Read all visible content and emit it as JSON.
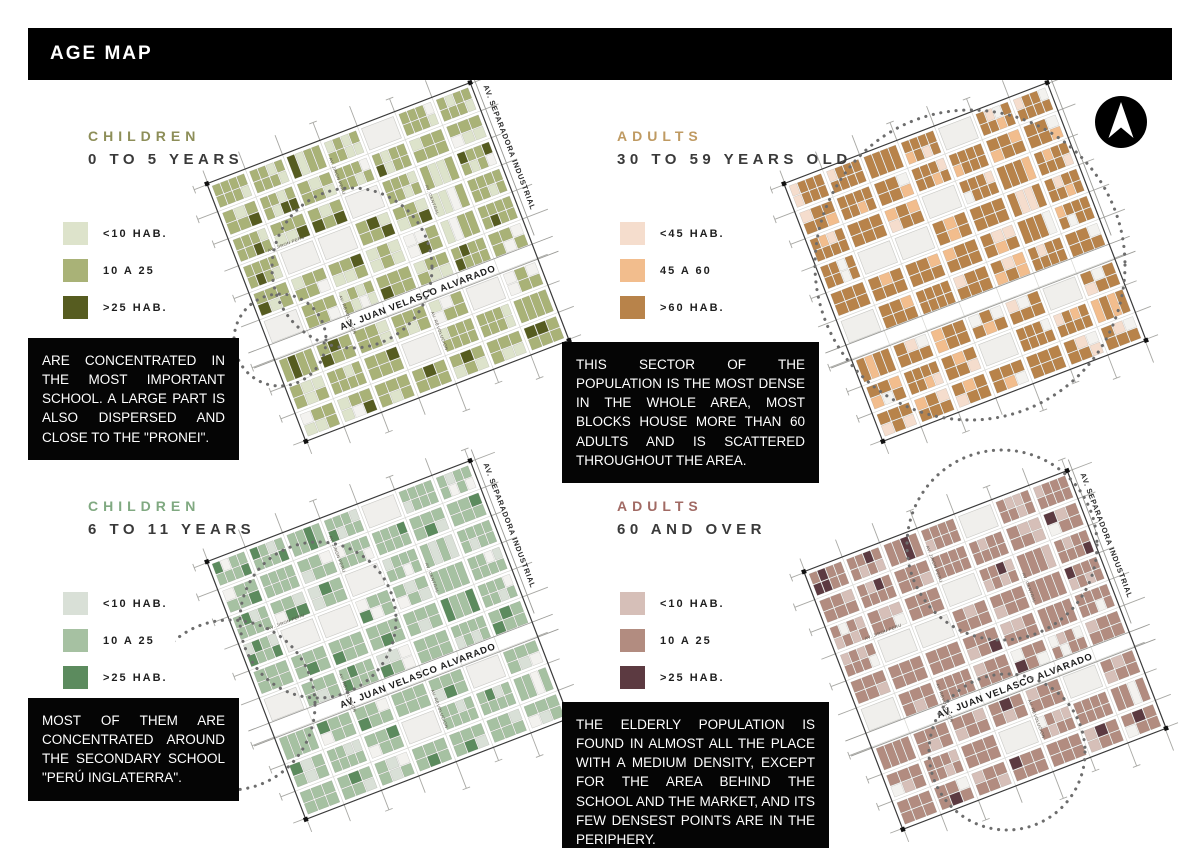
{
  "page": {
    "title": "AGE MAP",
    "background": "#ffffff",
    "header_bg": "#000000",
    "header_text_color": "#ffffff"
  },
  "north_arrow": {
    "icon": "north-arrow",
    "bg": "#000000",
    "fg": "#ffffff"
  },
  "map_shared": {
    "rotation": -21,
    "geo_seed": 1337,
    "plazas": [
      [
        0,
        4
      ],
      [
        2,
        3
      ],
      [
        3,
        1
      ],
      [
        3,
        2
      ],
      [
        5,
        0
      ],
      [
        6,
        5
      ],
      [
        7,
        3
      ]
    ],
    "street_color": "#a8a8a4",
    "border_color": "#3a3a3a",
    "dotted_circle_color": "#6d6d6d"
  },
  "map_labels": {
    "main_avenue": "AV. JUAN VELASCO ALVARADO",
    "industrial_avenue": "AV. SEPARADORA INDUSTRIAL",
    "minor_streets": [
      "AV. JIRON PERU",
      "AV. CENTRAL",
      "AV. REVOLUCION"
    ]
  },
  "panels": [
    {
      "id": "children-0-5",
      "title_line1": "CHILDREN",
      "title_line2": "0 TO 5 YEARS",
      "title_color": "#8d8e58",
      "legend": [
        {
          "label": "<10 HAB.",
          "color": "#dde3cb"
        },
        {
          "label": "10 A 25",
          "color": "#a9b277"
        },
        {
          "label": ">25 HAB.",
          "color": "#565c20"
        }
      ],
      "description": "ARE CONCENTRATED IN THE MOST IMPORTANT SCHOOL. A LARGE PART IS ALSO DISPERSED AND CLOSE TO THE \"PRONEI\".",
      "map": {
        "palette": {
          "light": "#dde3cb",
          "medium": "#a9b277",
          "dark": "#565c20",
          "vacant": "#f3f2ef",
          "plaza": "#f0efec"
        },
        "weights": {
          "light": 0.18,
          "medium": 0.7,
          "dark": 0.12
        },
        "color_seed": 11,
        "show_labels": true,
        "circles": [
          {
            "cx": 177,
            "cy": 193,
            "r": 80
          },
          {
            "cx": 105,
            "cy": 265,
            "r": 46
          }
        ]
      }
    },
    {
      "id": "adults-30-59",
      "title_line1": "ADULTS",
      "title_line2": "30 TO 59 YEARS OLD",
      "title_color": "#bf9a62",
      "legend": [
        {
          "label": "<45 HAB.",
          "color": "#f5ddcd"
        },
        {
          "label": "45 A 60",
          "color": "#f2bd8d"
        },
        {
          "label": ">60 HAB.",
          "color": "#b8834a"
        }
      ],
      "description": "THIS SECTOR OF THE POPULATION IS THE MOST DENSE IN THE WHOLE AREA, MOST BLOCKS HOUSE MORE THAN 60 ADULTS AND IS SCATTERED THROUGHOUT THE AREA.",
      "map": {
        "palette": {
          "light": "#f5ddcd",
          "medium": "#f2bd8d",
          "dark": "#b8834a",
          "vacant": "#f3f2ef",
          "plaza": "#f0efec"
        },
        "weights": {
          "light": 0.07,
          "medium": 0.13,
          "dark": 0.8
        },
        "color_seed": 23,
        "show_labels": false,
        "circles": [
          {
            "cx": 200,
            "cy": 190,
            "r": 155
          }
        ]
      }
    },
    {
      "id": "children-6-11",
      "title_line1": "CHILDREN",
      "title_line2": "6 TO 11 YEARS",
      "title_color": "#80a981",
      "legend": [
        {
          "label": "<10 HAB.",
          "color": "#d9e0d7"
        },
        {
          "label": "10 A 25",
          "color": "#a6c1a2"
        },
        {
          "label": ">25 HAB.",
          "color": "#5c8b5e"
        }
      ],
      "description": "MOST OF THEM ARE CONCENTRATED AROUND THE SECONDARY SCHOOL \"PERÚ INGLATERRA\".",
      "map": {
        "palette": {
          "light": "#d9e0d7",
          "medium": "#a6c1a2",
          "dark": "#5c8b5e",
          "vacant": "#f3f2ef",
          "plaza": "#f0efec"
        },
        "weights": {
          "light": 0.12,
          "medium": 0.77,
          "dark": 0.11
        },
        "color_seed": 37,
        "show_labels": true,
        "circles": [
          {
            "cx": 143,
            "cy": 175,
            "r": 78
          },
          {
            "cx": 55,
            "cy": 260,
            "r": 85
          }
        ]
      }
    },
    {
      "id": "adults-60-over",
      "title_line1": "ADULTS",
      "title_line2": "60 AND OVER",
      "title_color": "#a16a64",
      "legend": [
        {
          "label": "<10 HAB.",
          "color": "#d6bfb8"
        },
        {
          "label": "10 A 25",
          "color": "#b28c80"
        },
        {
          "label": ">25 HAB.",
          "color": "#5c3a41"
        }
      ],
      "description": "THE ELDERLY POPULATION IS FOUND IN ALMOST ALL THE PLACE WITH A MEDIUM DENSITY, EXCEPT FOR THE AREA BEHIND THE SCHOOL AND THE MARKET, AND ITS FEW DENSEST POINTS ARE IN THE PERIPHERY.",
      "map": {
        "palette": {
          "light": "#d6bfb8",
          "medium": "#b28c80",
          "dark": "#5c3a41",
          "vacant": "#f3f2ef",
          "plaza": "#f0efec"
        },
        "weights": {
          "light": 0.16,
          "medium": 0.78,
          "dark": 0.06
        },
        "color_seed": 53,
        "show_labels": true,
        "circles": [
          {
            "cx": 237,
            "cy": 107,
            "r": 95
          },
          {
            "cx": 242,
            "cy": 314,
            "r": 78
          }
        ]
      }
    }
  ]
}
